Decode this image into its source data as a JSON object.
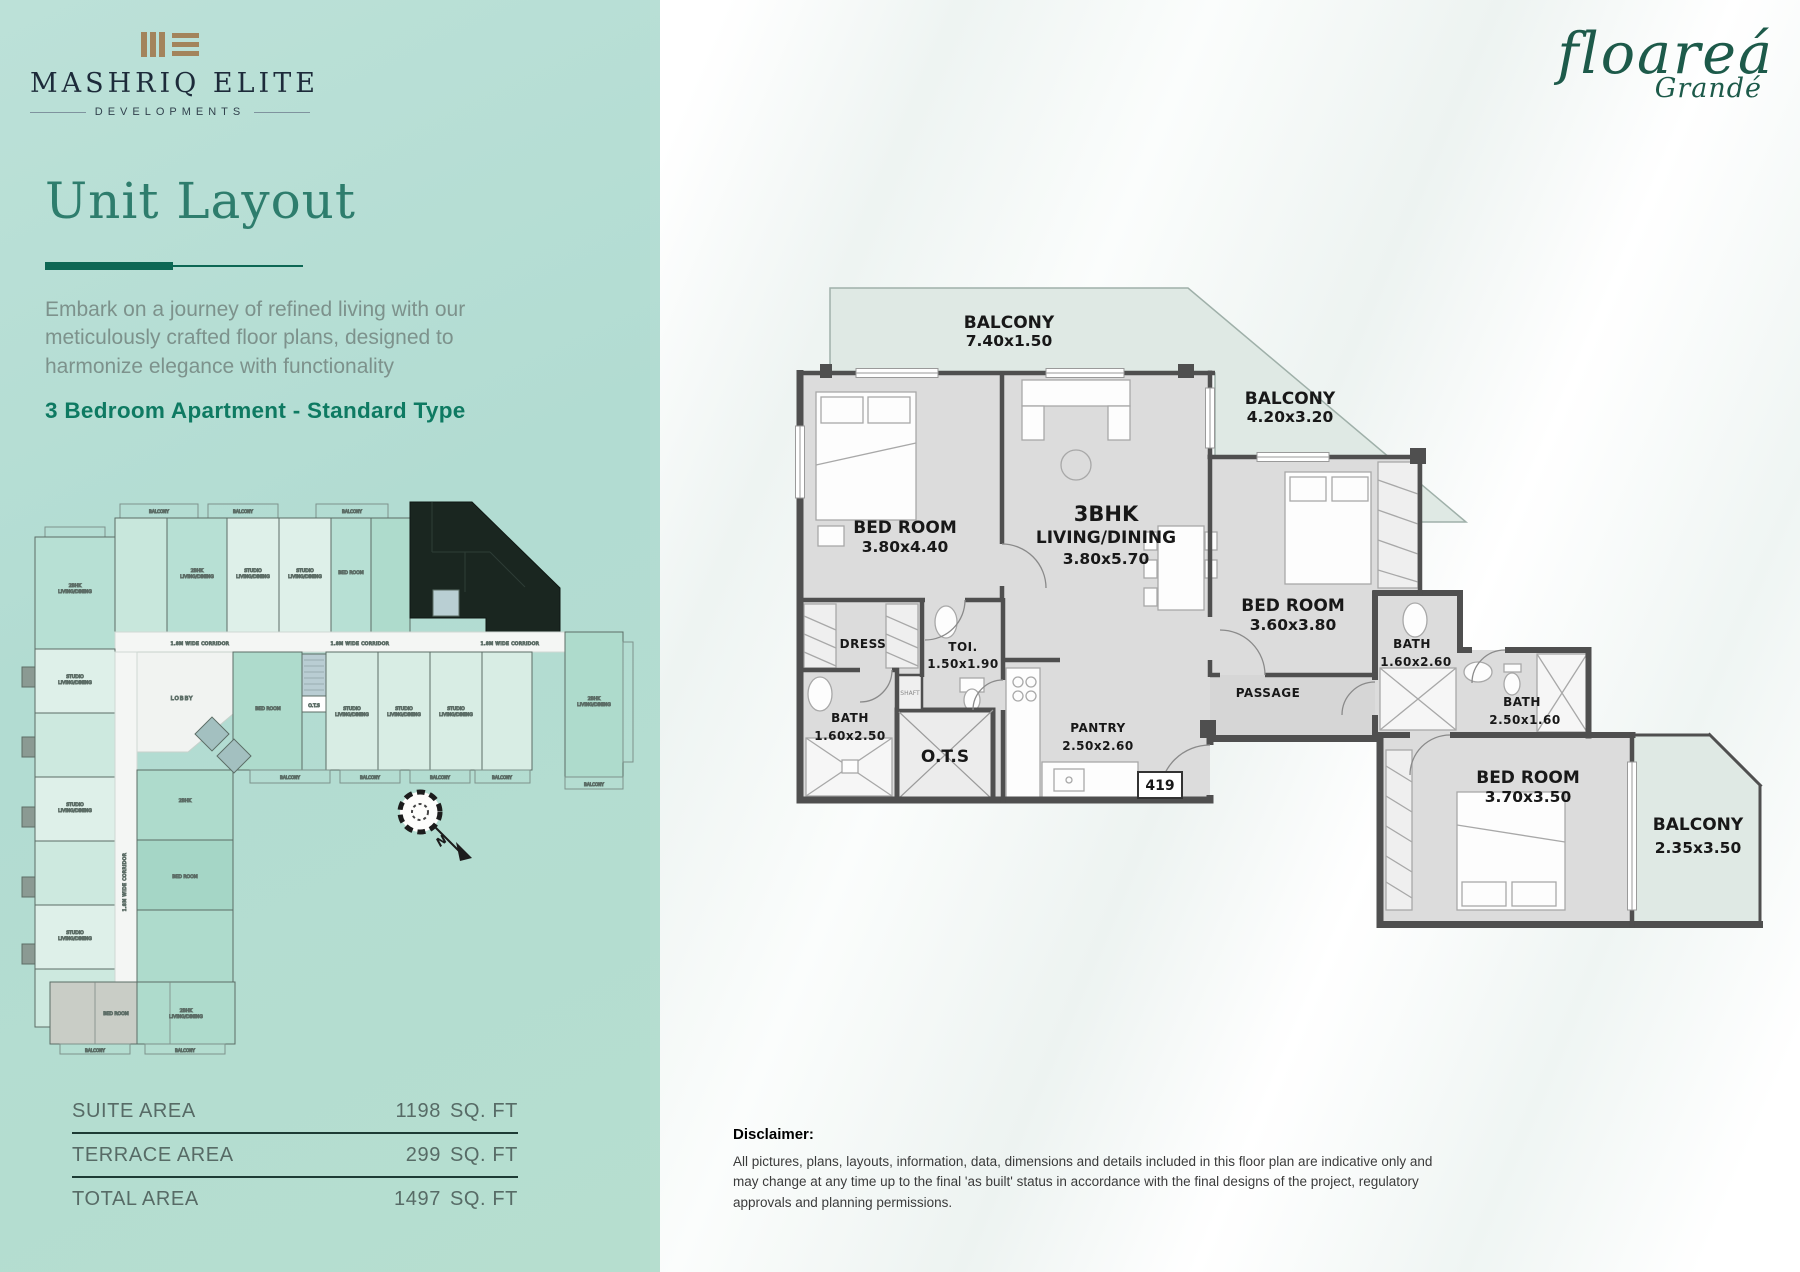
{
  "brand": {
    "name": "MASHRIQ ELITE",
    "sub": "DEVELOPMENTS"
  },
  "project": {
    "name": "floareá",
    "sub": "Grandé"
  },
  "sidebar": {
    "title": "Unit Layout",
    "description": "Embark on a journey of refined living with our meticulously crafted floor plans, designed to harmonize elegance with functionality",
    "unit_type": "3 Bedroom Apartment - Standard Type",
    "areas": [
      {
        "label": "SUITE AREA",
        "value": "1198",
        "unit": "SQ. FT"
      },
      {
        "label": "TERRACE AREA",
        "value": "299",
        "unit": "SQ. FT"
      },
      {
        "label": "TOTAL AREA",
        "value": "1497",
        "unit": "SQ. FT"
      }
    ]
  },
  "floor_plan": {
    "unit_number": "419",
    "rooms": [
      {
        "name": "BALCONY",
        "dims": "7.40x1.50"
      },
      {
        "name": "BALCONY",
        "dims": "4.20x3.20"
      },
      {
        "name": "BED ROOM",
        "dims": "3.80x4.40"
      },
      {
        "name": "3BHK",
        "name2": "LIVING/DINING",
        "dims": "3.80x5.70"
      },
      {
        "name": "BED ROOM",
        "dims": "3.60x3.80"
      },
      {
        "name": "DRESS"
      },
      {
        "name": "TOI.",
        "dims": "1.50x1.90"
      },
      {
        "name": "BATH",
        "dims": "1.60x2.50"
      },
      {
        "name": "O.T.S"
      },
      {
        "name": "PANTRY",
        "dims": "2.50x2.60"
      },
      {
        "name": "PASSAGE"
      },
      {
        "name": "BATH",
        "dims": "1.60x2.60"
      },
      {
        "name": "BATH",
        "dims": "2.50x1.60"
      },
      {
        "name": "BED ROOM",
        "dims": "3.70x3.50"
      },
      {
        "name": "BALCONY",
        "dims": "2.35x3.50"
      },
      {
        "name": "SHAFT"
      }
    ]
  },
  "key_plan": {
    "labels": {
      "corridor": "1.8M WIDE CORRIDOR",
      "lobby": "LOBBY",
      "balcony": "BALCONY",
      "studio": "STUDIO",
      "living_dining": "LIVING/DINING",
      "bhk2": "2BHK",
      "bedroom": "BED ROOM",
      "ots": "O.T.S"
    }
  },
  "compass": {
    "north": "N"
  },
  "disclaimer": {
    "title": "Disclaimer:",
    "text": "All pictures, plans, layouts, information, data, dimensions and details included in this floor plan are indicative only and may change at any time up to the final 'as built' status in accordance with the final designs of the project, regulatory approvals and planning permissions."
  }
}
